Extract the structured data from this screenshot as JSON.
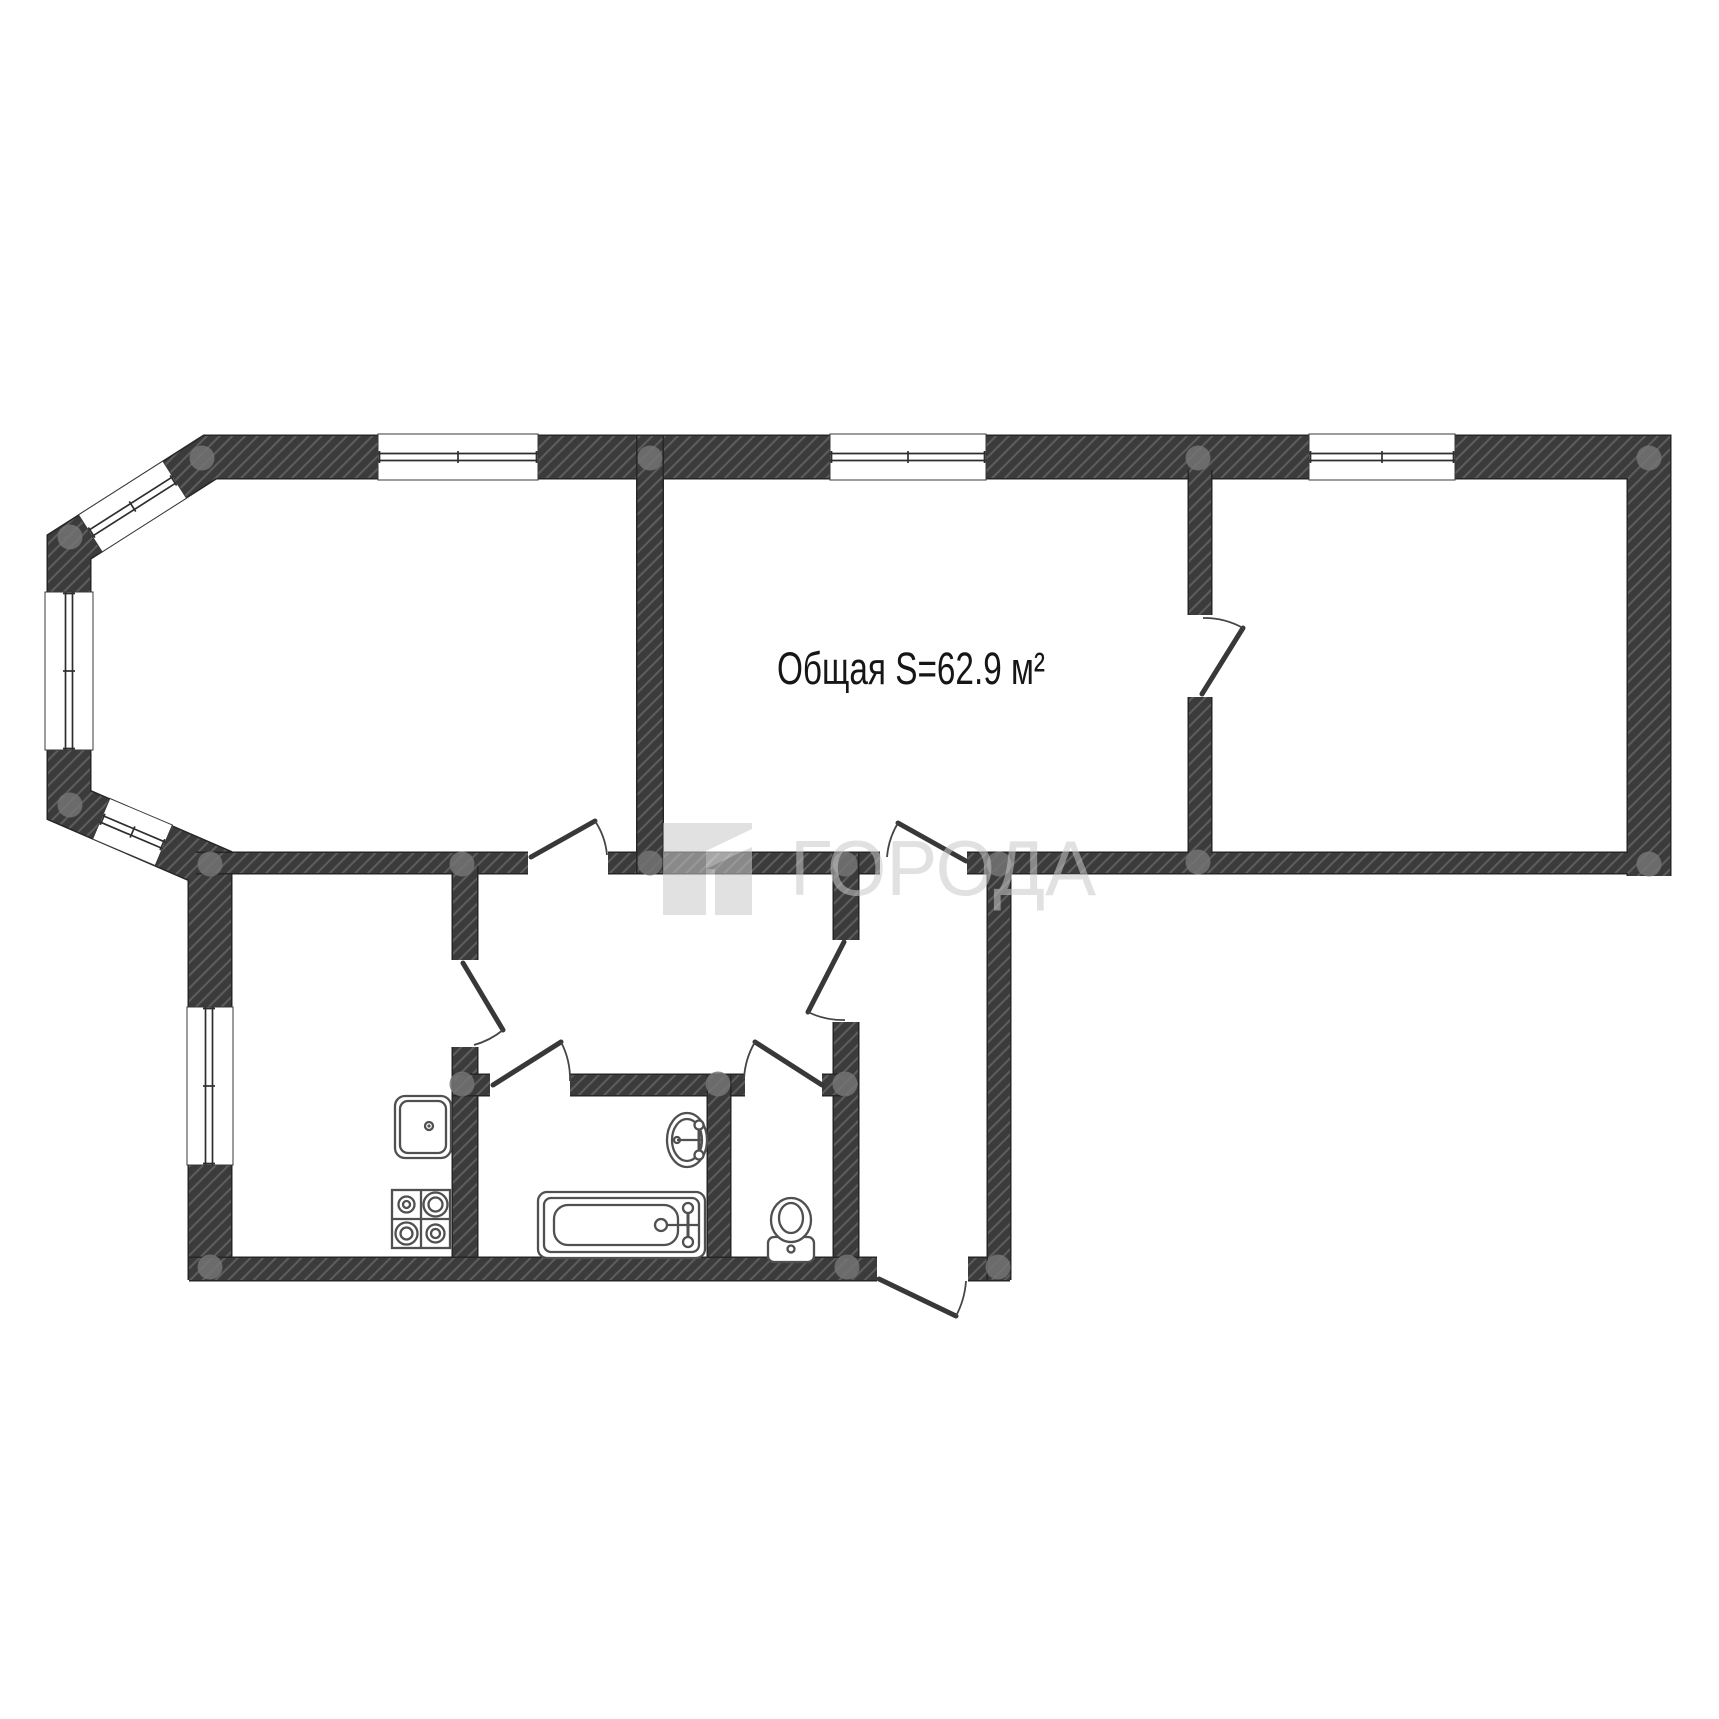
{
  "plan": {
    "area_label": "Общая S=62.9 м²",
    "watermark": {
      "text": "ГОРОДА",
      "opacity": "0.55",
      "color": "#c9c9c9"
    },
    "colors": {
      "background": "#ffffff",
      "wall_fill": "#3b3b3b",
      "wall_hatch": "#5e5e5e",
      "wall_outline": "#262626",
      "door_line": "#383838",
      "fixture_stroke": "#505050",
      "node_dot": "#747474",
      "label_text": "#161616"
    },
    "symbols": {
      "windows": 6,
      "doors": 8,
      "fixture_icons": [
        "kitchen-sink-icon",
        "stove-icon",
        "bathtub-icon",
        "washbasin-icon",
        "toilet-icon"
      ]
    }
  }
}
